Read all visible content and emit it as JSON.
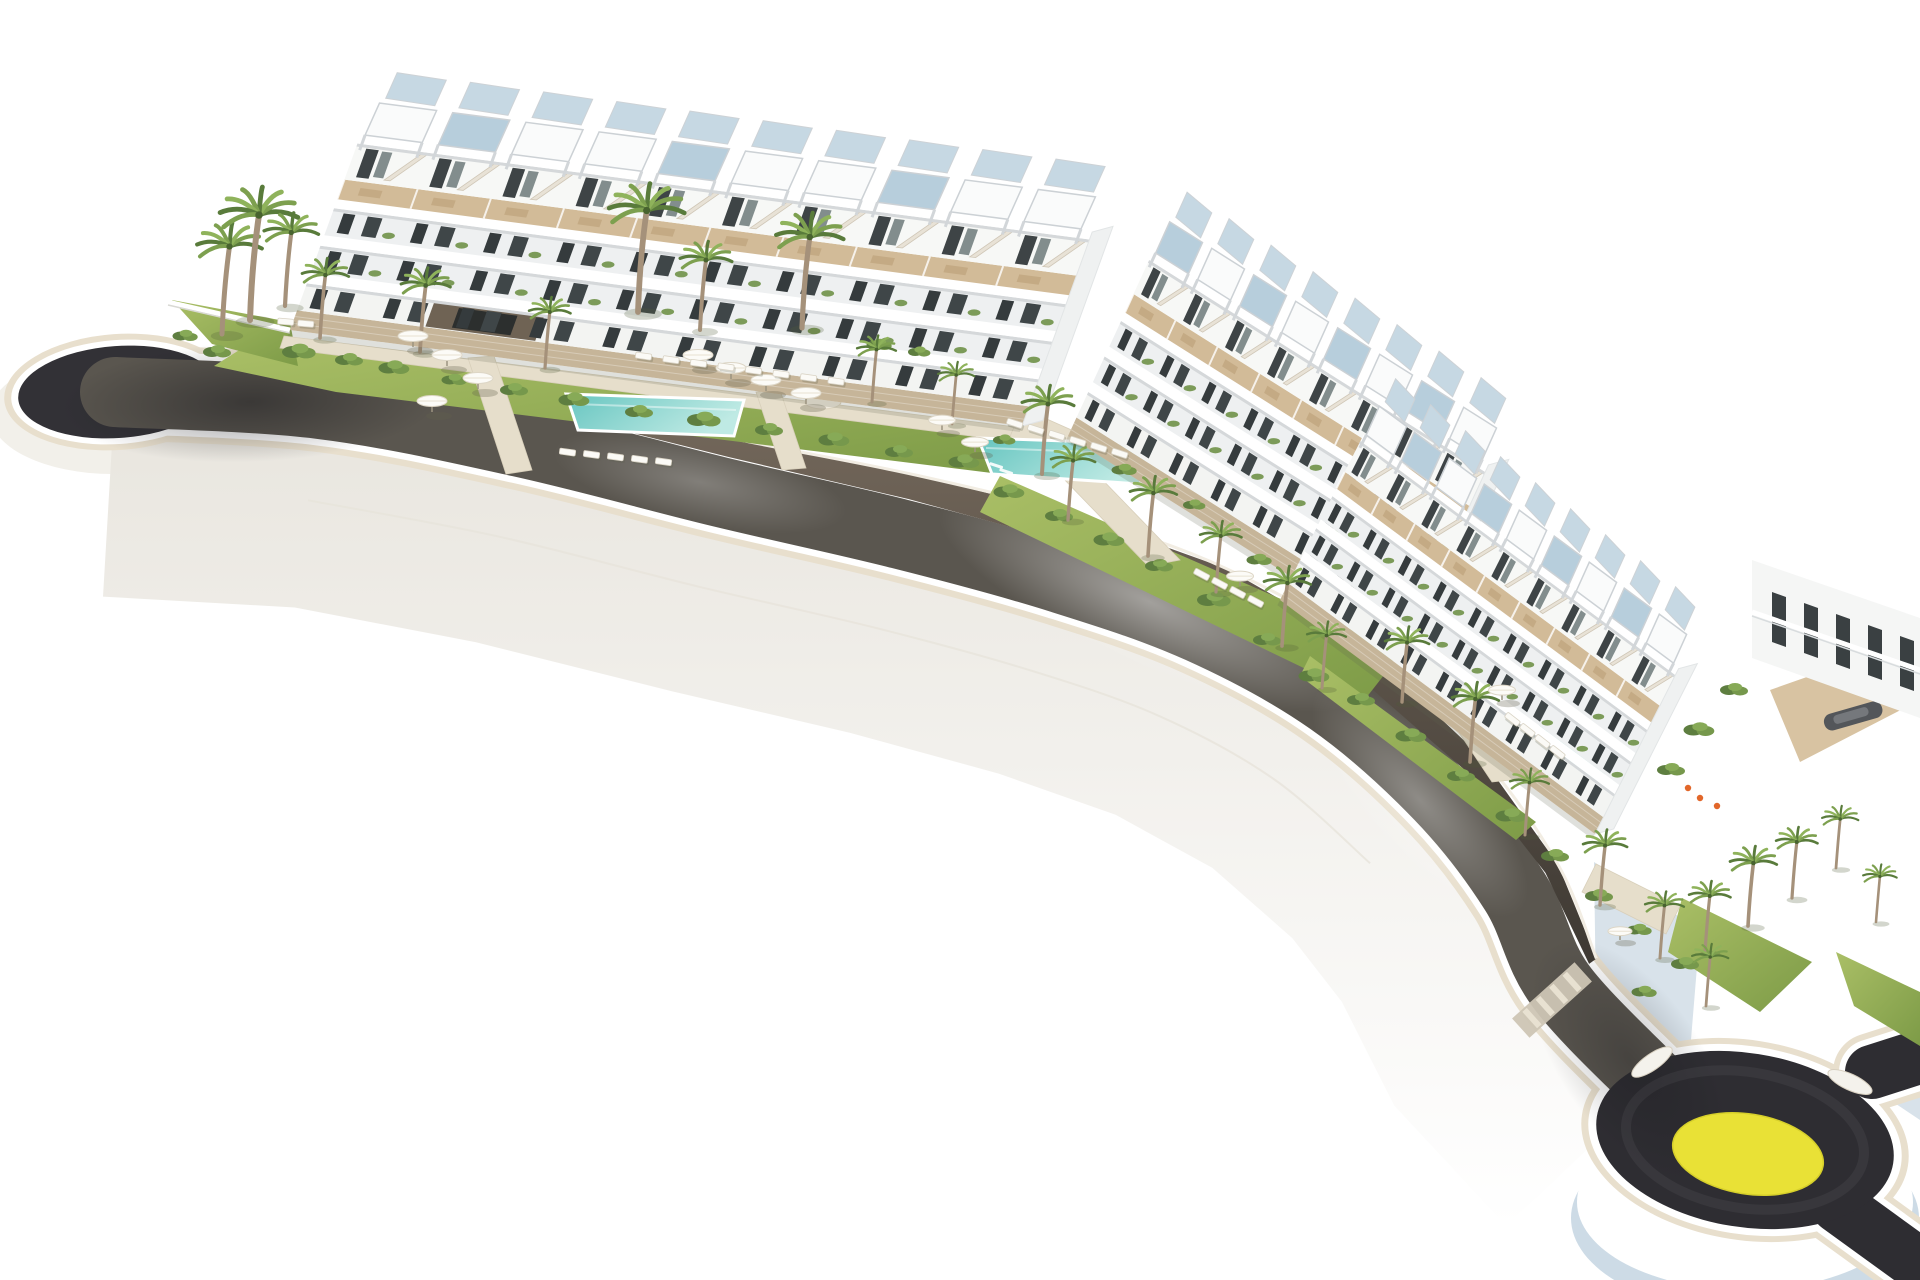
{
  "scene": {
    "kind": "aerial-3d-architectural-render",
    "description": "White terraced apartment complex of three stepped blocks with rooftop pergolas, gardens, palm trees, sun umbrellas, loungers and turquoise pools, above a dark curving access road that starts in a cul-de-sac bulb on the left and ends in a roundabout with a yellow painted island at the lower right, all on a white background.",
    "background": "#ffffff"
  },
  "palette": {
    "asphalt_mid": "#5a564f",
    "asphalt_dark": "#323136",
    "asphalt_ring": "#2e2d32",
    "curb_white": "#ffffff",
    "curb_beige": "#e8dfcd",
    "cliff": "#f2f0ea",
    "wall_top_cap": "#f2ede3",
    "lawn_light": "#aabf66",
    "lawn_dark": "#7d9b47",
    "shrub_dark": "#5e7e40",
    "shrub_mid": "#76984c",
    "shrub_light": "#87aa57",
    "palm_leaf_a": "#597b3b",
    "palm_leaf_b": "#7da04f",
    "palm_leaf_c": "#8fb35b",
    "palm_trunk": "#a5917a",
    "pool_deep": "#66c5c0",
    "pool_pale": "#bfeae4",
    "building_white": "#f7f8f6",
    "building_shade": "#eef0f1",
    "window_dark": "#353b3d",
    "deck_tan": "#d2bb98",
    "stone": "#c6b599",
    "pergola_panel": "#b7cedc",
    "pergola_panel_back": "#c6d8e3",
    "roundabout_yellow": "#e9e136",
    "platform_blue": "#cddbe6",
    "accent_orange": "#e2672a"
  },
  "road": {
    "width": 70,
    "centerline": [
      [
        115,
        392
      ],
      [
        320,
        404
      ],
      [
        520,
        442
      ],
      [
        720,
        492
      ],
      [
        900,
        534
      ],
      [
        1060,
        578
      ],
      [
        1200,
        628
      ],
      [
        1330,
        700
      ],
      [
        1440,
        796
      ],
      [
        1515,
        892
      ],
      [
        1560,
        985
      ],
      [
        1655,
        1085
      ]
    ],
    "culdesac": {
      "cx": 118,
      "cy": 392,
      "rx": 100,
      "ry": 46,
      "rot": -4
    },
    "roundabout": {
      "cx": 1745,
      "cy": 1140,
      "rx": 150,
      "ry": 87,
      "rot": 9,
      "island": {
        "cx": 1748,
        "cy": 1154,
        "rx": 76,
        "ry": 40
      },
      "cusps": [
        [
          1652,
          1062,
          -35
        ],
        [
          1850,
          1082,
          25
        ]
      ]
    },
    "stubs": [
      [
        [
          1872,
          1072
        ],
        [
          1922,
          1056
        ]
      ],
      [
        [
          1838,
          1206
        ],
        [
          1918,
          1264
        ]
      ]
    ],
    "stub_width": 54,
    "crosswalk": {
      "x": 1552,
      "y": 1000,
      "angle": 48,
      "thickness": 26,
      "span": 84
    },
    "wall_heights": [
      12,
      18,
      24,
      28,
      28,
      26,
      20,
      14,
      8
    ]
  },
  "buildings": [
    {
      "name": "block-a",
      "origin": [
        290,
        330
      ],
      "axis": [
        73.2,
        9.6
      ],
      "units": 10,
      "up": [
        0.34,
        -0.94
      ],
      "scale": 0.8,
      "panel_mod": 3,
      "panel_rem": 1,
      "feature": {
        "from": 1.75,
        "to": 3.25,
        "fill": "#6f6354"
      }
    },
    {
      "name": "block-b",
      "origin": [
        1068,
        436
      ],
      "axis": [
        42,
        26.5
      ],
      "units": 8,
      "up": [
        0.42,
        -0.91
      ],
      "scale": 0.78,
      "panel_mod": 2,
      "panel_rem": 0
    },
    {
      "name": "block-c",
      "origin": [
        1280,
        600
      ],
      "axis": [
        35,
        26
      ],
      "units": 9,
      "up": [
        0.45,
        -0.89
      ],
      "scale": 0.72,
      "panel_mod": 2,
      "panel_rem": 1
    }
  ],
  "gardens": {
    "lawns": [
      [
        [
          252,
          342
        ],
        [
          1018,
          436
        ],
        [
          1000,
          474
        ],
        [
          336,
          392
        ],
        [
          214,
          366
        ]
      ],
      [
        [
          172,
          300
        ],
        [
          290,
          322
        ],
        [
          298,
          366
        ],
        [
          212,
          344
        ]
      ],
      [
        [
          1000,
          476
        ],
        [
          1402,
          652
        ],
        [
          1366,
          698
        ],
        [
          980,
          512
        ]
      ],
      [
        [
          1310,
          656
        ],
        [
          1536,
          822
        ],
        [
          1516,
          840
        ],
        [
          1300,
          676
        ]
      ],
      [
        [
          1682,
          898
        ],
        [
          1812,
          962
        ],
        [
          1760,
          1012
        ],
        [
          1668,
          952
        ]
      ],
      [
        [
          1836,
          952
        ],
        [
          1920,
          992
        ],
        [
          1920,
          1046
        ],
        [
          1854,
          1006
        ]
      ]
    ],
    "paths": [
      [
        [
          284,
          336
        ],
        [
          1024,
          428
        ],
        [
          1018,
          442
        ],
        [
          280,
          348
        ]
      ],
      [
        [
          468,
          358
        ],
        [
          494,
          356
        ],
        [
          532,
          470
        ],
        [
          506,
          474
        ]
      ],
      [
        [
          756,
          392
        ],
        [
          780,
          390
        ],
        [
          806,
          468
        ],
        [
          782,
          470
        ]
      ],
      [
        [
          1032,
          446
        ],
        [
          1066,
          442
        ],
        [
          1180,
          560
        ],
        [
          1148,
          566
        ]
      ],
      [
        [
          1404,
          650
        ],
        [
          1446,
          668
        ],
        [
          1530,
          778
        ],
        [
          1492,
          782
        ]
      ],
      [
        [
          1596,
          864
        ],
        [
          1680,
          906
        ],
        [
          1666,
          934
        ],
        [
          1582,
          892
        ]
      ],
      [
        [
          1022,
          408
        ],
        [
          1076,
          432
        ],
        [
          1060,
          470
        ],
        [
          1006,
          446
        ]
      ],
      [
        [
          1406,
          630
        ],
        [
          1454,
          660
        ],
        [
          1436,
          700
        ],
        [
          1390,
          668
        ]
      ]
    ],
    "pools": [
      {
        "name": "pool-block-a",
        "points": [
          [
            566,
            394
          ],
          [
            744,
            400
          ],
          [
            734,
            436
          ],
          [
            578,
            430
          ]
        ]
      },
      {
        "name": "pool-block-b",
        "points": [
          [
            978,
            438
          ],
          [
            1152,
            444
          ],
          [
            1140,
            484
          ],
          [
            992,
            474
          ]
        ]
      },
      {
        "name": "pool-block-c",
        "points": [
          [
            1540,
            722
          ],
          [
            1610,
            770
          ],
          [
            1588,
            800
          ],
          [
            1518,
            752
          ]
        ]
      }
    ],
    "paved_circle": {
      "cx": 823,
      "cy": 402,
      "rx": 18,
      "ry": 7
    },
    "garden_wall": [
      [
        168,
        302
      ],
      [
        290,
        330
      ]
    ],
    "palms": [
      [
        222,
        334,
        1.25
      ],
      [
        250,
        320,
        1.5
      ],
      [
        285,
        306,
        1.05
      ],
      [
        320,
        338,
        0.9
      ],
      [
        420,
        352,
        0.95
      ],
      [
        545,
        368,
        0.8
      ],
      [
        638,
        312,
        1.45
      ],
      [
        700,
        330,
        1.0
      ],
      [
        802,
        328,
        1.3
      ],
      [
        872,
        402,
        0.75
      ],
      [
        952,
        424,
        0.7
      ],
      [
        1042,
        474,
        1.0
      ],
      [
        1068,
        520,
        0.85
      ],
      [
        1148,
        556,
        0.9
      ],
      [
        1216,
        592,
        0.8
      ],
      [
        1282,
        646,
        0.9
      ],
      [
        1322,
        688,
        0.75
      ],
      [
        1402,
        702,
        0.85
      ],
      [
        1470,
        762,
        0.9
      ],
      [
        1525,
        835,
        0.75
      ],
      [
        1600,
        905,
        0.85
      ],
      [
        1660,
        958,
        0.75
      ],
      [
        1705,
        952,
        0.8
      ],
      [
        1748,
        926,
        0.9
      ],
      [
        1792,
        898,
        0.8
      ],
      [
        1836,
        868,
        0.7
      ],
      [
        1876,
        922,
        0.65
      ],
      [
        1706,
        1006,
        0.7
      ]
    ],
    "umbrellas": [
      [
        413,
        347,
        1
      ],
      [
        447,
        366,
        1
      ],
      [
        478,
        389,
        1
      ],
      [
        432,
        412,
        1
      ],
      [
        698,
        366,
        1
      ],
      [
        731,
        379,
        1
      ],
      [
        766,
        391,
        1
      ],
      [
        806,
        404,
        1
      ],
      [
        942,
        430,
        0.9
      ],
      [
        975,
        452,
        0.9
      ],
      [
        1240,
        586,
        0.9
      ],
      [
        1502,
        700,
        0.9
      ],
      [
        1620,
        940,
        0.8
      ]
    ],
    "lounger_rows": [
      {
        "start": [
          636,
          352
        ],
        "step": [
          27.5,
          3.6
        ],
        "count": 8,
        "angle": 8
      },
      {
        "start": [
          560,
          448
        ],
        "step": [
          24,
          2.4
        ],
        "count": 5,
        "angle": 8
      },
      {
        "start": [
          1008,
          418
        ],
        "step": [
          21,
          6
        ],
        "count": 6,
        "angle": 18
      },
      {
        "start": [
          1196,
          568
        ],
        "step": [
          18,
          9
        ],
        "count": 4,
        "angle": 28
      },
      {
        "start": [
          1508,
          712
        ],
        "step": [
          15,
          11
        ],
        "count": 4,
        "angle": 38
      },
      {
        "start": [
          278,
          318
        ],
        "step": [
          20,
          2
        ],
        "count": 2,
        "angle": 5
      }
    ],
    "shrubs": [
      [
        300,
        352,
        1.2
      ],
      [
        350,
        360,
        1
      ],
      [
        395,
        368,
        1.1
      ],
      [
        455,
        380,
        0.9
      ],
      [
        515,
        390,
        1
      ],
      [
        575,
        400,
        1.1
      ],
      [
        640,
        412,
        1
      ],
      [
        705,
        420,
        1.2
      ],
      [
        770,
        430,
        1
      ],
      [
        835,
        440,
        1.1
      ],
      [
        900,
        452,
        1
      ],
      [
        965,
        462,
        1.1
      ],
      [
        218,
        352,
        1
      ],
      [
        186,
        336,
        0.9
      ],
      [
        1010,
        492,
        1.1
      ],
      [
        1060,
        516,
        1
      ],
      [
        1110,
        540,
        1.1
      ],
      [
        1160,
        566,
        1
      ],
      [
        1215,
        600,
        1.2
      ],
      [
        1268,
        640,
        1
      ],
      [
        1315,
        676,
        1.1
      ],
      [
        1362,
        700,
        1
      ],
      [
        1412,
        736,
        1.1
      ],
      [
        1462,
        776,
        1
      ],
      [
        1512,
        816,
        1.1
      ],
      [
        1556,
        856,
        1
      ],
      [
        1600,
        896,
        1
      ],
      [
        1640,
        930,
        0.9
      ],
      [
        1686,
        964,
        1
      ],
      [
        1645,
        992,
        0.9
      ],
      [
        1735,
        690,
        1
      ],
      [
        1700,
        730,
        1.1
      ],
      [
        1672,
        770,
        1
      ],
      [
        880,
        345,
        0.9
      ],
      [
        920,
        352,
        0.8
      ],
      [
        1005,
        440,
        0.8
      ],
      [
        1125,
        470,
        0.9
      ],
      [
        1195,
        505,
        0.8
      ],
      [
        1260,
        560,
        0.9
      ]
    ],
    "pool_steps": [
      [
        990,
        462
      ],
      [
        1000,
        468
      ],
      [
        1010,
        474
      ]
    ]
  },
  "terrace": {
    "walls": [
      [
        [
          1594,
          862
        ],
        [
          1700,
          930
        ],
        [
          1690,
          1052
        ],
        [
          1596,
          1002
        ]
      ],
      [
        [
          1860,
          1046
        ],
        [
          1920,
          1036
        ],
        [
          1920,
          1120
        ],
        [
          1878,
          1092
        ]
      ]
    ],
    "deck": [
      [
        1770,
        690
      ],
      [
        1912,
        640
      ],
      [
        1920,
        700
      ],
      [
        1800,
        762
      ]
    ],
    "boat": {
      "x": 1822,
      "y": 716,
      "w": 60,
      "h": 17,
      "rot": -16
    },
    "accents": [
      [
        1700,
        798
      ],
      [
        1717,
        806
      ],
      [
        1688,
        788
      ]
    ],
    "corner": {
      "poly": [
        [
          1752,
          560
        ],
        [
          1920,
          618
        ],
        [
          1920,
          718
        ],
        [
          1752,
          658
        ]
      ],
      "openings": 5,
      "o_start": [
        1772,
        592
      ],
      "o_step": [
        32,
        11
      ]
    }
  }
}
